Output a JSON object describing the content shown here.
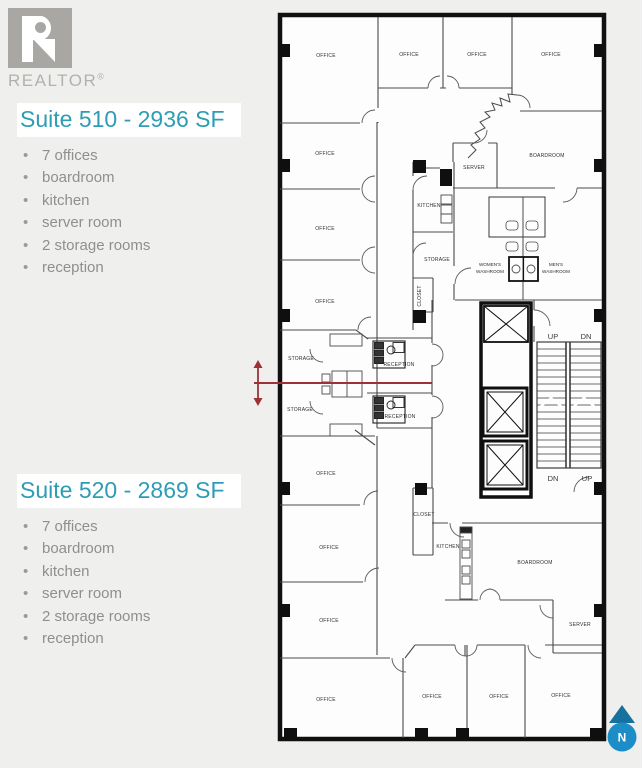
{
  "brand": {
    "logo_icon": "realtor-r-logo",
    "wordmark": "REALTOR",
    "registered_mark": "®"
  },
  "suite_510": {
    "title": "Suite 510 - 2936 SF",
    "features": [
      "7 offices",
      "boardroom",
      "kitchen",
      "server room",
      "2 storage rooms",
      "reception"
    ]
  },
  "suite_520": {
    "title": "Suite 520 - 2869 SF",
    "features": [
      "7 offices",
      "boardroom",
      "kitchen",
      "server room",
      "2 storage rooms",
      "reception"
    ]
  },
  "floorplan": {
    "room_labels": [
      "OFFICE",
      "OFFICE",
      "OFFICE",
      "OFFICE",
      "OFFICE",
      "SERVER",
      "BOARDROOM",
      "KITCHEN",
      "OFFICE",
      "STORAGE",
      "OFFICE",
      "CLOSET",
      "STORAGE",
      "RECEPTION",
      "STORAGE",
      "RECEPTION",
      "OFFICE",
      "CLOSET",
      "OFFICE",
      "KITCHEN",
      "BOARDROOM",
      "OFFICE",
      "SERVER",
      "OFFICE",
      "OFFICE",
      "OFFICE",
      "OFFICE"
    ],
    "washrooms": {
      "womens": [
        "WOMEN'S",
        "WASHROOM"
      ],
      "mens": [
        "MEN'S",
        "WASHROOM"
      ]
    },
    "stairs": {
      "upper_left": "UP",
      "upper_right": "DN",
      "lower_left": "DN",
      "lower_right": "UP"
    },
    "north_label": "N",
    "colors": {
      "suite_title": "#2d9cb5",
      "demising_line": "#9e3138",
      "north_circle": "#1c8dc6",
      "north_triangle": "#17719f",
      "logo_gray": "#a8a7a4"
    }
  }
}
